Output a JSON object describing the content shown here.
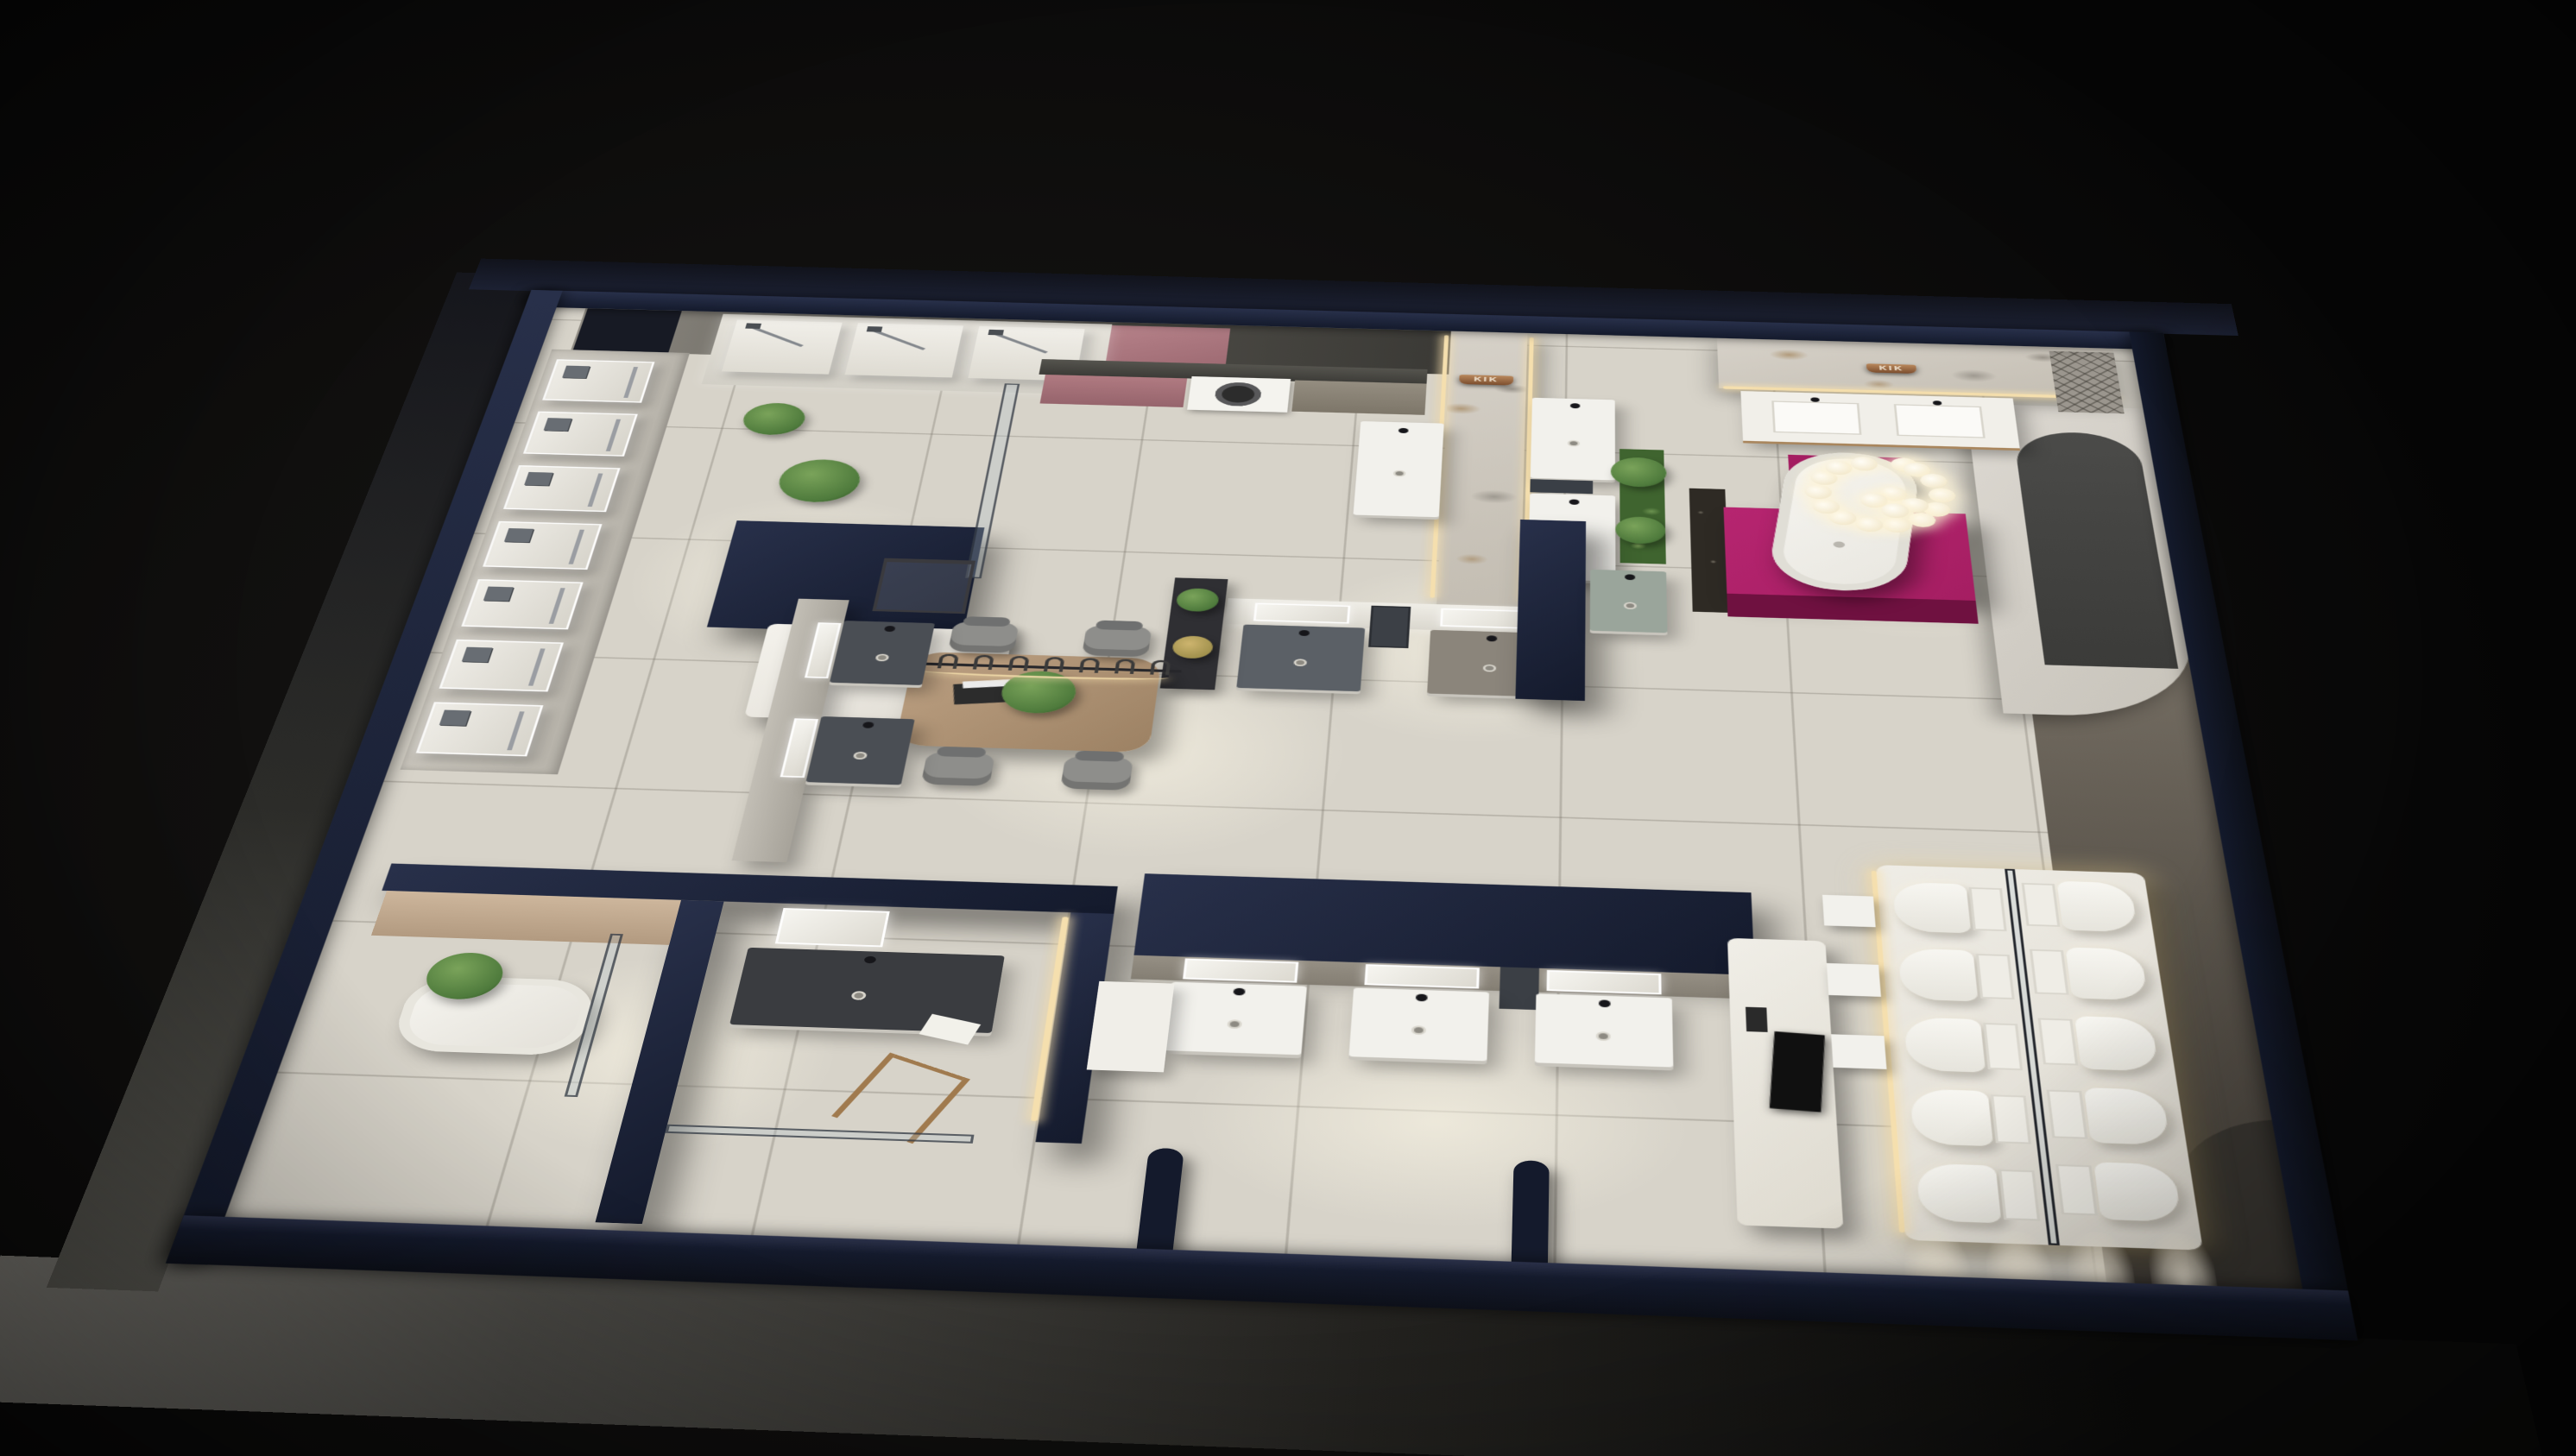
{
  "scene": {
    "title": "Sanitary-ware showroom — night dollhouse 3D view",
    "view": "top-down axonometric render, dark surroundings"
  },
  "signs": {
    "marble_wall_center": "KIK",
    "marble_wall_right": "KIK",
    "reception_desk": "····· ·····"
  },
  "colors": {
    "navy": "#141a2c",
    "navy-light": "#28304a",
    "floor": "#d7d3c9",
    "marble-base": "#cdc7bd",
    "magenta": "#a51e62",
    "magenta-dark": "#6f1140",
    "pink-panel": "#b27e86",
    "mauve-cabinet": "#a76f77",
    "wood": "#b4997a",
    "charcoal": "#44423e",
    "gray-wall": "#8f8b83",
    "fixture-white": "#f2f1ec",
    "sage": "#9aa59b",
    "led": "#f5dfae",
    "glass": "rgba(175,195,205,0.28)",
    "green": "#4e7a3c",
    "green-light": "#7aa35a",
    "bronze": "#a5714a",
    "tv-black": "#101010"
  },
  "inventory": {
    "faucet_display_panels": 7,
    "shower_display_columns": 3,
    "washing_machines": 1,
    "dining_chairs": 4,
    "pendant_hooks": 7,
    "toilets": 10,
    "chandelier_bulbs": 18,
    "bathtubs": 2,
    "vanity_units": 14,
    "wall_signs": 2,
    "light_scallops": 4,
    "plants": 9
  }
}
